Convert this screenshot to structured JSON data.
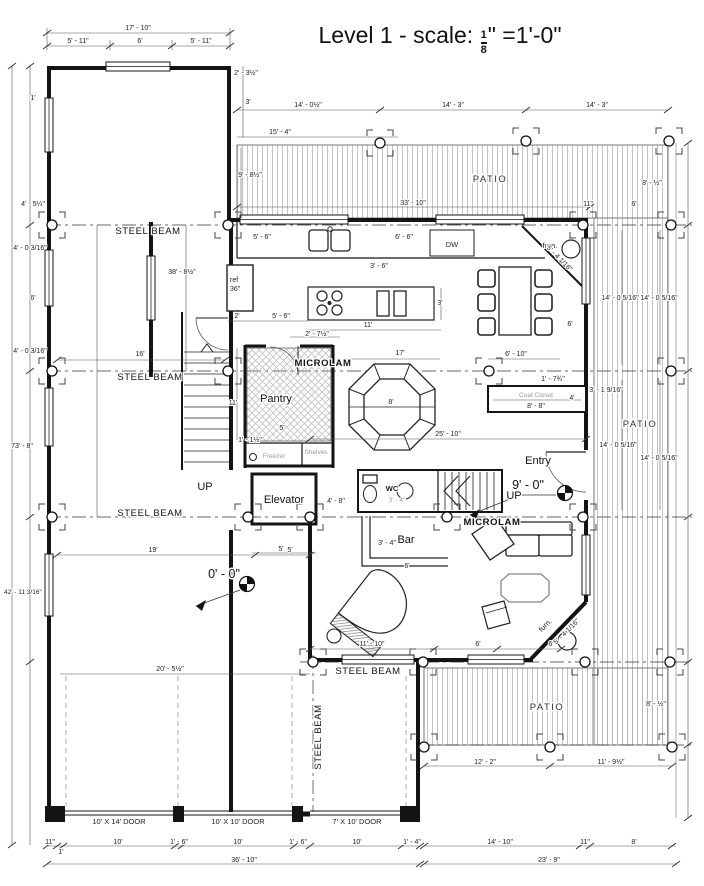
{
  "title": {
    "prefix": "Level 1 - scale:",
    "frac_num": "1",
    "frac_den": "8",
    "suffix": "\" =1'-0\""
  },
  "rooms": {
    "patio_top": "PATIO",
    "patio_right": "PATIO",
    "patio_bottom": "PATIO",
    "pantry": "Pantry",
    "freezer": "Freezer",
    "shelves": "Shelves",
    "elevator": "Elevator",
    "wc": "WC",
    "bar": "Bar",
    "entry": "Entry",
    "coat_closet": "Coat Closet",
    "up_left": "UP",
    "up_mid": "UP",
    "dw": "DW",
    "ref_l1": "ref",
    "ref_l2": "36\"",
    "furn_top": "furn.",
    "furn_bottom": "furn.",
    "microlam_top": "MICROLAM",
    "microlam_mid": "MICROLAM"
  },
  "beams": {
    "sb1": "STEEL BEAM",
    "sb2": "STEEL BEAM",
    "sb3": "STEEL BEAM",
    "sb4": "STEEL BEAM",
    "sb_v": "STEEL BEAM"
  },
  "garage_doors": [
    "10' X 14' DOOR",
    "10' X 10' DOOR",
    "7' X 10' DOOR"
  ],
  "levels": {
    "main": "0' - 0\"",
    "entry": "9' - 0\""
  },
  "dims": {
    "t_total": "17' - 10\"",
    "t_a": "5' - 11\"",
    "t_b": "6'",
    "t_c": "5' - 11\"",
    "l_top": "1'",
    "wing_r1": "2' - 3½\"",
    "wing_r2": "3'",
    "p_a": "14' - 0½\"",
    "p_b": "14' - 3\"",
    "p_c": "14' - 3\"",
    "k_top": "15' - 4\"",
    "p_depth": "9' - 8½\"",
    "p_width": "33' - 10\"",
    "r_a": "8' - ½\"",
    "r_b": "6'",
    "r_c": "11\"",
    "l_a": "4' - 5¼\"",
    "l_b": "4' - 0 3/16\"",
    "l_c": "6'",
    "l_d": "4' - 0 3/16\"",
    "l_total": "73' - 8\"",
    "l_low": "42' - 11 3/16\"",
    "wing_h": "38' - 8½\"",
    "wing_w": "16'",
    "c_a": "5' - 6\"",
    "c_b": "6' - 6\"",
    "c_c": "3' - 6\"",
    "i_len": "11'",
    "i_dep": "3'",
    "i_a": "2'",
    "i_b": "5' - 6\"",
    "i_c": "2' - 7½\"",
    "d_diag": "5' - 4 1/16\"",
    "d_side": "6'",
    "o_top": "17'",
    "o_mid": "8'",
    "main_w": "25' - 10\"",
    "hall": "6' - 10\"",
    "pan_h": "11'",
    "pan_w": "5'",
    "pan_b": "1' - 1½\"",
    "cc_len": "8' - 8\"",
    "cc_d": "4'",
    "cc_s": "1' - 7¾\"",
    "wall_s": "3' - 1 9/16\"",
    "el_r": "4' - 8\"",
    "el_b": "5'",
    "wc_w": "3' - 4\"",
    "bar_h": "3' - 4\"",
    "bar_w": "6'",
    "lv_a": "19'",
    "lv_b": "5'",
    "gar_w": "20' - 5½\"",
    "lb_a": "11' - 10\"",
    "lb_b": "6'",
    "lb_c": "6'",
    "pr": "14' - 0 5/16\"",
    "pb_a": "12' - 2\"",
    "pb_b": "11' - 9½\"",
    "b_a": "14' - 10\"",
    "b_b": "11\"",
    "b_c": "8'",
    "b_total": "23' - 9\"",
    "g_total": "36' - 10\"",
    "g_segs": [
      "11\"",
      "1'",
      "10'",
      "1' - 6\"",
      "10'",
      "1' - 6\"",
      "10'",
      "1' - 4\""
    ]
  }
}
